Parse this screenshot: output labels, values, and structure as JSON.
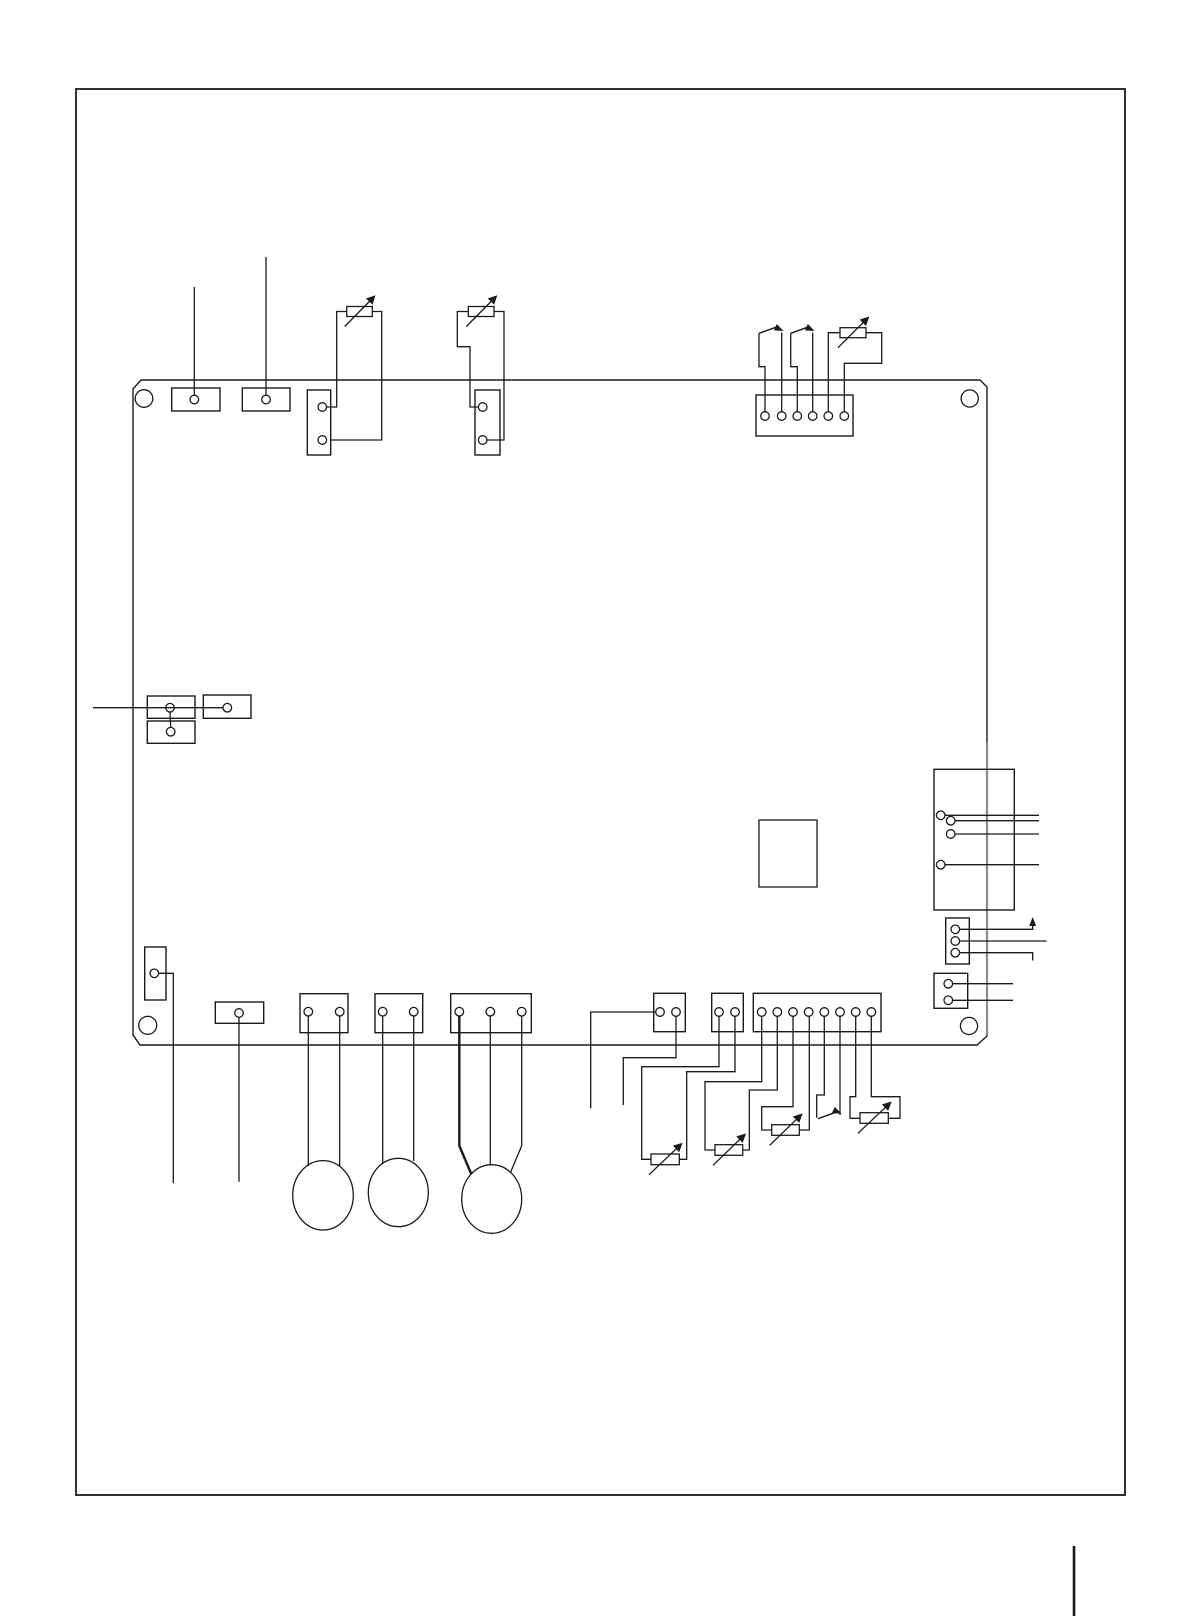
{
  "meta": {
    "title": "control-board-wiring-diagram-page",
    "canvas": {
      "w": 1191,
      "h": 1616
    },
    "colors": {
      "ink": "#1a1a1a",
      "grey": "#8a8a8a",
      "paper": "#ffffff"
    },
    "pin_radius": 4.3
  },
  "page": {
    "border": {
      "x": 76,
      "y": 89,
      "w": 1049,
      "h": 1406
    },
    "crop_mark": {
      "x1": 1074,
      "y1": 1546,
      "x2": 1074,
      "y2": 1616
    }
  },
  "board": {
    "outline": [
      [
        141,
        380
      ],
      [
        980,
        380
      ],
      [
        987,
        387
      ],
      [
        987,
        1036
      ],
      [
        977,
        1045
      ],
      [
        140,
        1045
      ],
      [
        133,
        1035
      ],
      [
        133,
        389
      ]
    ],
    "grey_edge": {
      "x1": 987,
      "y1": 742,
      "x2": 987,
      "y2": 1035
    },
    "holes": [
      {
        "cx": 144,
        "cy": 398.5,
        "r": 8.8
      },
      {
        "cx": 969.7,
        "cy": 398.5,
        "r": 8.6
      },
      {
        "cx": 147.7,
        "cy": 1025.3,
        "r": 9
      },
      {
        "cx": 969,
        "cy": 1026,
        "r": 8.6
      }
    ]
  },
  "connectors": [
    {
      "name": "terminal-a",
      "x": 171.7,
      "y": 388,
      "w": 48.3,
      "h": 23,
      "pins": [
        [
          194.3,
          399.5
        ]
      ]
    },
    {
      "name": "terminal-b",
      "x": 242.3,
      "y": 388,
      "w": 47.7,
      "h": 23,
      "pins": [
        [
          266,
          399.5
        ]
      ]
    },
    {
      "name": "connector-c-2pin",
      "x": 307.3,
      "y": 390,
      "w": 23.4,
      "h": 65,
      "pins": [
        [
          322.3,
          407
        ],
        [
          322.3,
          440
        ]
      ]
    },
    {
      "name": "connector-d-2pin",
      "x": 475,
      "y": 390,
      "w": 25,
      "h": 65,
      "pins": [
        [
          482.7,
          407
        ],
        [
          482.7,
          440
        ]
      ]
    },
    {
      "name": "connector-top-6pin",
      "x": 756,
      "y": 395,
      "w": 97,
      "h": 41,
      "pins": [
        [
          765,
          416
        ],
        [
          781.7,
          416
        ],
        [
          797.3,
          416
        ],
        [
          812.7,
          416
        ],
        [
          828.3,
          416
        ],
        [
          844.3,
          416
        ]
      ]
    },
    {
      "name": "jumper-a1",
      "x": 147.3,
      "y": 696,
      "w": 47.7,
      "h": 22.3,
      "pins": [
        [
          170,
          707.7
        ]
      ]
    },
    {
      "name": "jumper-a2",
      "x": 147.3,
      "y": 721,
      "w": 47.7,
      "h": 22.3,
      "pins": [
        [
          170.7,
          731.7
        ]
      ]
    },
    {
      "name": "jumper-b",
      "x": 203.3,
      "y": 695,
      "w": 47.7,
      "h": 23.3,
      "pins": [
        [
          227.3,
          707.7
        ]
      ]
    },
    {
      "name": "connector-m-4pin",
      "x": 934,
      "y": 769.3,
      "w": 80.3,
      "h": 140.7,
      "pins": [
        [
          940.7,
          815.3
        ],
        [
          950.7,
          820.7
        ],
        [
          950.7,
          834
        ],
        [
          940.7,
          864.7
        ]
      ]
    },
    {
      "name": "connector-n-3pin",
      "x": 945.7,
      "y": 918,
      "w": 23.6,
      "h": 46,
      "pins": [
        [
          955.3,
          929.3
        ],
        [
          955.3,
          941
        ],
        [
          955.3,
          952.7
        ]
      ]
    },
    {
      "name": "connector-p-2pin",
      "x": 934,
      "y": 973.3,
      "w": 33.7,
      "h": 35,
      "pins": [
        [
          948.3,
          983.7
        ],
        [
          948.3,
          1000.3
        ]
      ]
    },
    {
      "name": "connector-e-1pin",
      "x": 144.7,
      "y": 947,
      "w": 21.3,
      "h": 53,
      "pins": [
        [
          154.3,
          973.3
        ]
      ]
    },
    {
      "name": "connector-f-1pin",
      "x": 215.3,
      "y": 1002,
      "w": 48.4,
      "h": 21.3,
      "pins": [
        [
          239,
          1013
        ]
      ]
    },
    {
      "name": "connector-g-2pin",
      "x": 300,
      "y": 993.7,
      "w": 48,
      "h": 39,
      "pins": [
        [
          308.3,
          1011.7
        ],
        [
          339.7,
          1011.7
        ]
      ]
    },
    {
      "name": "connector-h-2pin",
      "x": 375,
      "y": 993.7,
      "w": 47.7,
      "h": 39,
      "pins": [
        [
          382.7,
          1011.7
        ],
        [
          413.7,
          1011.7
        ]
      ]
    },
    {
      "name": "connector-i-3pin",
      "x": 450.7,
      "y": 993.7,
      "w": 80.6,
      "h": 39,
      "pins": [
        [
          459.3,
          1011.7
        ],
        [
          490.3,
          1011.7
        ],
        [
          521.7,
          1011.7
        ]
      ]
    },
    {
      "name": "connector-j-2pin",
      "x": 653.7,
      "y": 993.3,
      "w": 31.6,
      "h": 38.4,
      "pins": [
        [
          660,
          1012
        ],
        [
          676,
          1012
        ]
      ]
    },
    {
      "name": "connector-k-2pin",
      "x": 711.7,
      "y": 993.3,
      "w": 31.6,
      "h": 38.4,
      "pins": [
        [
          719,
          1012
        ],
        [
          735,
          1012
        ]
      ]
    },
    {
      "name": "connector-l-8pin",
      "x": 753.3,
      "y": 993.3,
      "w": 127.7,
      "h": 38.4,
      "pins": [
        [
          761.7,
          1012
        ],
        [
          777.3,
          1012
        ],
        [
          793,
          1012
        ],
        [
          808.7,
          1012
        ],
        [
          824.3,
          1012
        ],
        [
          840,
          1012
        ],
        [
          855.7,
          1012
        ],
        [
          871.3,
          1012
        ]
      ]
    }
  ],
  "ic_block": {
    "name": "ic-block",
    "x": 759,
    "y": 820,
    "w": 58,
    "h": 67
  },
  "varistors": [
    {
      "name": "varistor-r1",
      "x": 346.7,
      "y": 306.5,
      "w": 25.6,
      "h": 10
    },
    {
      "name": "varistor-r2",
      "x": 468.3,
      "y": 306.5,
      "w": 25.7,
      "h": 10
    },
    {
      "name": "varistor-r3",
      "x": 840,
      "y": 327.7,
      "w": 26,
      "h": 10
    },
    {
      "name": "varistor-ra",
      "x": 651,
      "y": 1154,
      "w": 28.3,
      "h": 10.7
    },
    {
      "name": "varistor-rb",
      "x": 715,
      "y": 1144.7,
      "w": 27.7,
      "h": 10.6
    },
    {
      "name": "varistor-rc",
      "x": 771.7,
      "y": 1124.7,
      "w": 27.6,
      "h": 10.6
    },
    {
      "name": "varistor-rd",
      "x": 860,
      "y": 1112.7,
      "w": 28.3,
      "h": 10.6
    }
  ],
  "switch_blades": [
    {
      "name": "switch-1-blade",
      "x1": 759,
      "y1": 333.3,
      "x2": 778.5,
      "y2": 326.3
    },
    {
      "name": "switch-2-blade",
      "x1": 790.7,
      "y1": 333.3,
      "x2": 810,
      "y2": 326.3
    },
    {
      "name": "switch-b-blade",
      "x1": 818,
      "y1": 1118.7,
      "x2": 838.5,
      "y2": 1111.3
    }
  ],
  "arrows": [
    {
      "name": "switch-1-arrow",
      "x": 783.5,
      "y": 331,
      "deg": 25
    },
    {
      "name": "switch-2-arrow",
      "x": 814.5,
      "y": 331,
      "deg": 25
    },
    {
      "name": "switch-b-arrow",
      "x": 841.5,
      "y": 1113.8,
      "deg": 25
    },
    {
      "name": "n-line-up-arrow",
      "x": 1032.7,
      "y": 917,
      "deg": -90
    }
  ],
  "motors": [
    {
      "name": "motor-1",
      "cx": 323,
      "cy": 1195.3,
      "rx": 30.3,
      "ry": 34.7
    },
    {
      "name": "motor-2",
      "cx": 398.3,
      "cy": 1192.5,
      "rx": 30,
      "ry": 34.2
    },
    {
      "name": "motor-3",
      "cx": 491.7,
      "cy": 1199,
      "rx": 30,
      "ry": 34.3
    }
  ],
  "wires": [
    {
      "name": "lead-terminal-a",
      "points": [
        [
          194.3,
          287
        ],
        [
          194.3,
          395.2
        ]
      ]
    },
    {
      "name": "lead-terminal-b",
      "points": [
        [
          266,
          257
        ],
        [
          266,
          395.2
        ]
      ]
    },
    {
      "name": "r1-left",
      "points": [
        [
          326.6,
          407
        ],
        [
          336.7,
          407
        ],
        [
          336.7,
          311.5
        ],
        [
          346.7,
          311.5
        ]
      ]
    },
    {
      "name": "r1-right",
      "points": [
        [
          372.3,
          311.5
        ],
        [
          381.7,
          311.5
        ],
        [
          381.7,
          440
        ],
        [
          330.9,
          440
        ]
      ]
    },
    {
      "name": "r2-left",
      "points": [
        [
          478.4,
          407
        ],
        [
          470,
          407
        ],
        [
          470,
          346.7
        ],
        [
          457.3,
          346.7
        ],
        [
          457.3,
          311.5
        ],
        [
          468.3,
          311.5
        ]
      ]
    },
    {
      "name": "r2-right",
      "points": [
        [
          494,
          311.5
        ],
        [
          504,
          311.5
        ],
        [
          504,
          440
        ],
        [
          487,
          440
        ]
      ]
    },
    {
      "name": "sw1-pole",
      "points": [
        [
          765,
          411.4
        ],
        [
          765,
          366.7
        ],
        [
          759,
          366.7
        ],
        [
          759,
          333.3
        ]
      ]
    },
    {
      "name": "sw1-throw",
      "points": [
        [
          781.7,
          411.4
        ],
        [
          781.7,
          332.5
        ]
      ]
    },
    {
      "name": "sw2-pole",
      "points": [
        [
          797.3,
          411.4
        ],
        [
          797.3,
          366.7
        ],
        [
          790.7,
          366.7
        ],
        [
          790.7,
          333.3
        ]
      ]
    },
    {
      "name": "sw2-throw",
      "points": [
        [
          812.7,
          411.4
        ],
        [
          812.7,
          332.5
        ]
      ]
    },
    {
      "name": "r3-left",
      "points": [
        [
          828.3,
          411.4
        ],
        [
          828.3,
          332.7
        ],
        [
          840,
          332.7
        ]
      ]
    },
    {
      "name": "r3-right",
      "points": [
        [
          866,
          332.7
        ],
        [
          881.7,
          332.7
        ],
        [
          881.7,
          363.3
        ],
        [
          844.3,
          363.3
        ],
        [
          844.3,
          411.4
        ]
      ]
    },
    {
      "name": "lead-left",
      "points": [
        [
          93,
          707.7
        ],
        [
          223,
          707.7
        ]
      ]
    },
    {
      "name": "jumper-link",
      "points": [
        [
          170,
          712
        ],
        [
          170.7,
          727.4
        ]
      ]
    },
    {
      "name": "m-line-1",
      "points": [
        [
          945,
          815.3
        ],
        [
          1039,
          815.3
        ]
      ]
    },
    {
      "name": "m-line-2",
      "points": [
        [
          955,
          820.7
        ],
        [
          1039,
          820.7
        ]
      ]
    },
    {
      "name": "m-line-3",
      "points": [
        [
          955,
          834
        ],
        [
          1039,
          834
        ]
      ]
    },
    {
      "name": "m-line-4",
      "points": [
        [
          945,
          864.7
        ],
        [
          1039,
          864.7
        ]
      ]
    },
    {
      "name": "n-line-1",
      "points": [
        [
          959.6,
          929.3
        ],
        [
          1032.7,
          929.3
        ],
        [
          1032.7,
          919.5
        ]
      ]
    },
    {
      "name": "n-line-2",
      "points": [
        [
          959.6,
          941
        ],
        [
          1046.7,
          941
        ]
      ]
    },
    {
      "name": "n-line-3",
      "points": [
        [
          959.6,
          952.7
        ],
        [
          1032.7,
          952.7
        ],
        [
          1032.7,
          960.5
        ]
      ]
    },
    {
      "name": "p-line-1",
      "points": [
        [
          952.6,
          983.7
        ],
        [
          1013,
          983.7
        ]
      ]
    },
    {
      "name": "p-line-2",
      "points": [
        [
          952.6,
          1000.3
        ],
        [
          1013,
          1000.3
        ]
      ]
    },
    {
      "name": "e-drop",
      "points": [
        [
          158.6,
          973.3
        ],
        [
          173.3,
          973.3
        ],
        [
          173.3,
          1183.3
        ]
      ]
    },
    {
      "name": "f-drop",
      "points": [
        [
          239,
          1017.3
        ],
        [
          239,
          1181.7
        ]
      ]
    },
    {
      "name": "g-motor-1",
      "points": [
        [
          308.3,
          1016
        ],
        [
          308.3,
          1166
        ]
      ]
    },
    {
      "name": "g-motor-2",
      "points": [
        [
          339.7,
          1016
        ],
        [
          339.7,
          1166
        ]
      ]
    },
    {
      "name": "h-motor-1",
      "points": [
        [
          382.7,
          1016
        ],
        [
          382.7,
          1163
        ]
      ]
    },
    {
      "name": "h-motor-2",
      "points": [
        [
          413.7,
          1016
        ],
        [
          413.7,
          1161
        ]
      ]
    },
    {
      "name": "i-motor-1",
      "points": [
        [
          459.3,
          1016
        ],
        [
          459.3,
          1145.7
        ],
        [
          471.5,
          1174.5
        ]
      ],
      "w": 2.4
    },
    {
      "name": "i-motor-2",
      "points": [
        [
          490.3,
          1016
        ],
        [
          490.3,
          1165
        ]
      ]
    },
    {
      "name": "i-motor-3",
      "points": [
        [
          521.7,
          1016
        ],
        [
          521.7,
          1145.7
        ],
        [
          510.5,
          1172.5
        ]
      ]
    },
    {
      "name": "j-drop-1",
      "points": [
        [
          655.7,
          1012
        ],
        [
          590.7,
          1012
        ],
        [
          590.7,
          1108.3
        ]
      ]
    },
    {
      "name": "j-drop-2",
      "points": [
        [
          676,
          1016.3
        ],
        [
          676,
          1057.7
        ],
        [
          623.3,
          1057.7
        ],
        [
          623.3,
          1105
        ]
      ]
    },
    {
      "name": "ra-left",
      "points": [
        [
          719,
          1016.3
        ],
        [
          719,
          1066.7
        ],
        [
          641.7,
          1066.7
        ],
        [
          641.7,
          1159.3
        ],
        [
          651,
          1159.3
        ]
      ]
    },
    {
      "name": "ra-right",
      "points": [
        [
          679.3,
          1159.3
        ],
        [
          686.7,
          1159.3
        ],
        [
          686.7,
          1071.7
        ],
        [
          735,
          1071.7
        ],
        [
          735,
          1016.3
        ]
      ]
    },
    {
      "name": "rb-left",
      "points": [
        [
          761.7,
          1016.3
        ],
        [
          761.7,
          1081.7
        ],
        [
          705,
          1081.7
        ],
        [
          705,
          1150
        ],
        [
          715,
          1150
        ]
      ]
    },
    {
      "name": "rb-right",
      "points": [
        [
          742.7,
          1150
        ],
        [
          749.3,
          1150
        ],
        [
          749.3,
          1090
        ],
        [
          777.3,
          1090
        ],
        [
          777.3,
          1016.3
        ]
      ]
    },
    {
      "name": "rc-left",
      "points": [
        [
          793,
          1016.3
        ],
        [
          793,
          1106.7
        ],
        [
          761.7,
          1106.7
        ],
        [
          761.7,
          1130
        ],
        [
          771.7,
          1130
        ]
      ]
    },
    {
      "name": "rc-right",
      "points": [
        [
          799.3,
          1130
        ],
        [
          809.3,
          1130
        ],
        [
          809.3,
          1016.3
        ]
      ]
    },
    {
      "name": "swb-pole",
      "points": [
        [
          824.3,
          1016.3
        ],
        [
          824.3,
          1095
        ],
        [
          816.7,
          1095
        ],
        [
          816.7,
          1117.7
        ]
      ]
    },
    {
      "name": "swb-throw",
      "points": [
        [
          840,
          1016.3
        ],
        [
          840,
          1115
        ]
      ]
    },
    {
      "name": "rd-left",
      "points": [
        [
          855.7,
          1016.3
        ],
        [
          855.7,
          1096.7
        ],
        [
          850,
          1096.7
        ],
        [
          850,
          1118.3
        ],
        [
          860,
          1118.3
        ]
      ]
    },
    {
      "name": "rd-right",
      "points": [
        [
          871.3,
          1016.3
        ],
        [
          871.3,
          1096.7
        ],
        [
          900,
          1096.7
        ],
        [
          900,
          1118.3
        ],
        [
          888.3,
          1118.3
        ]
      ]
    }
  ]
}
